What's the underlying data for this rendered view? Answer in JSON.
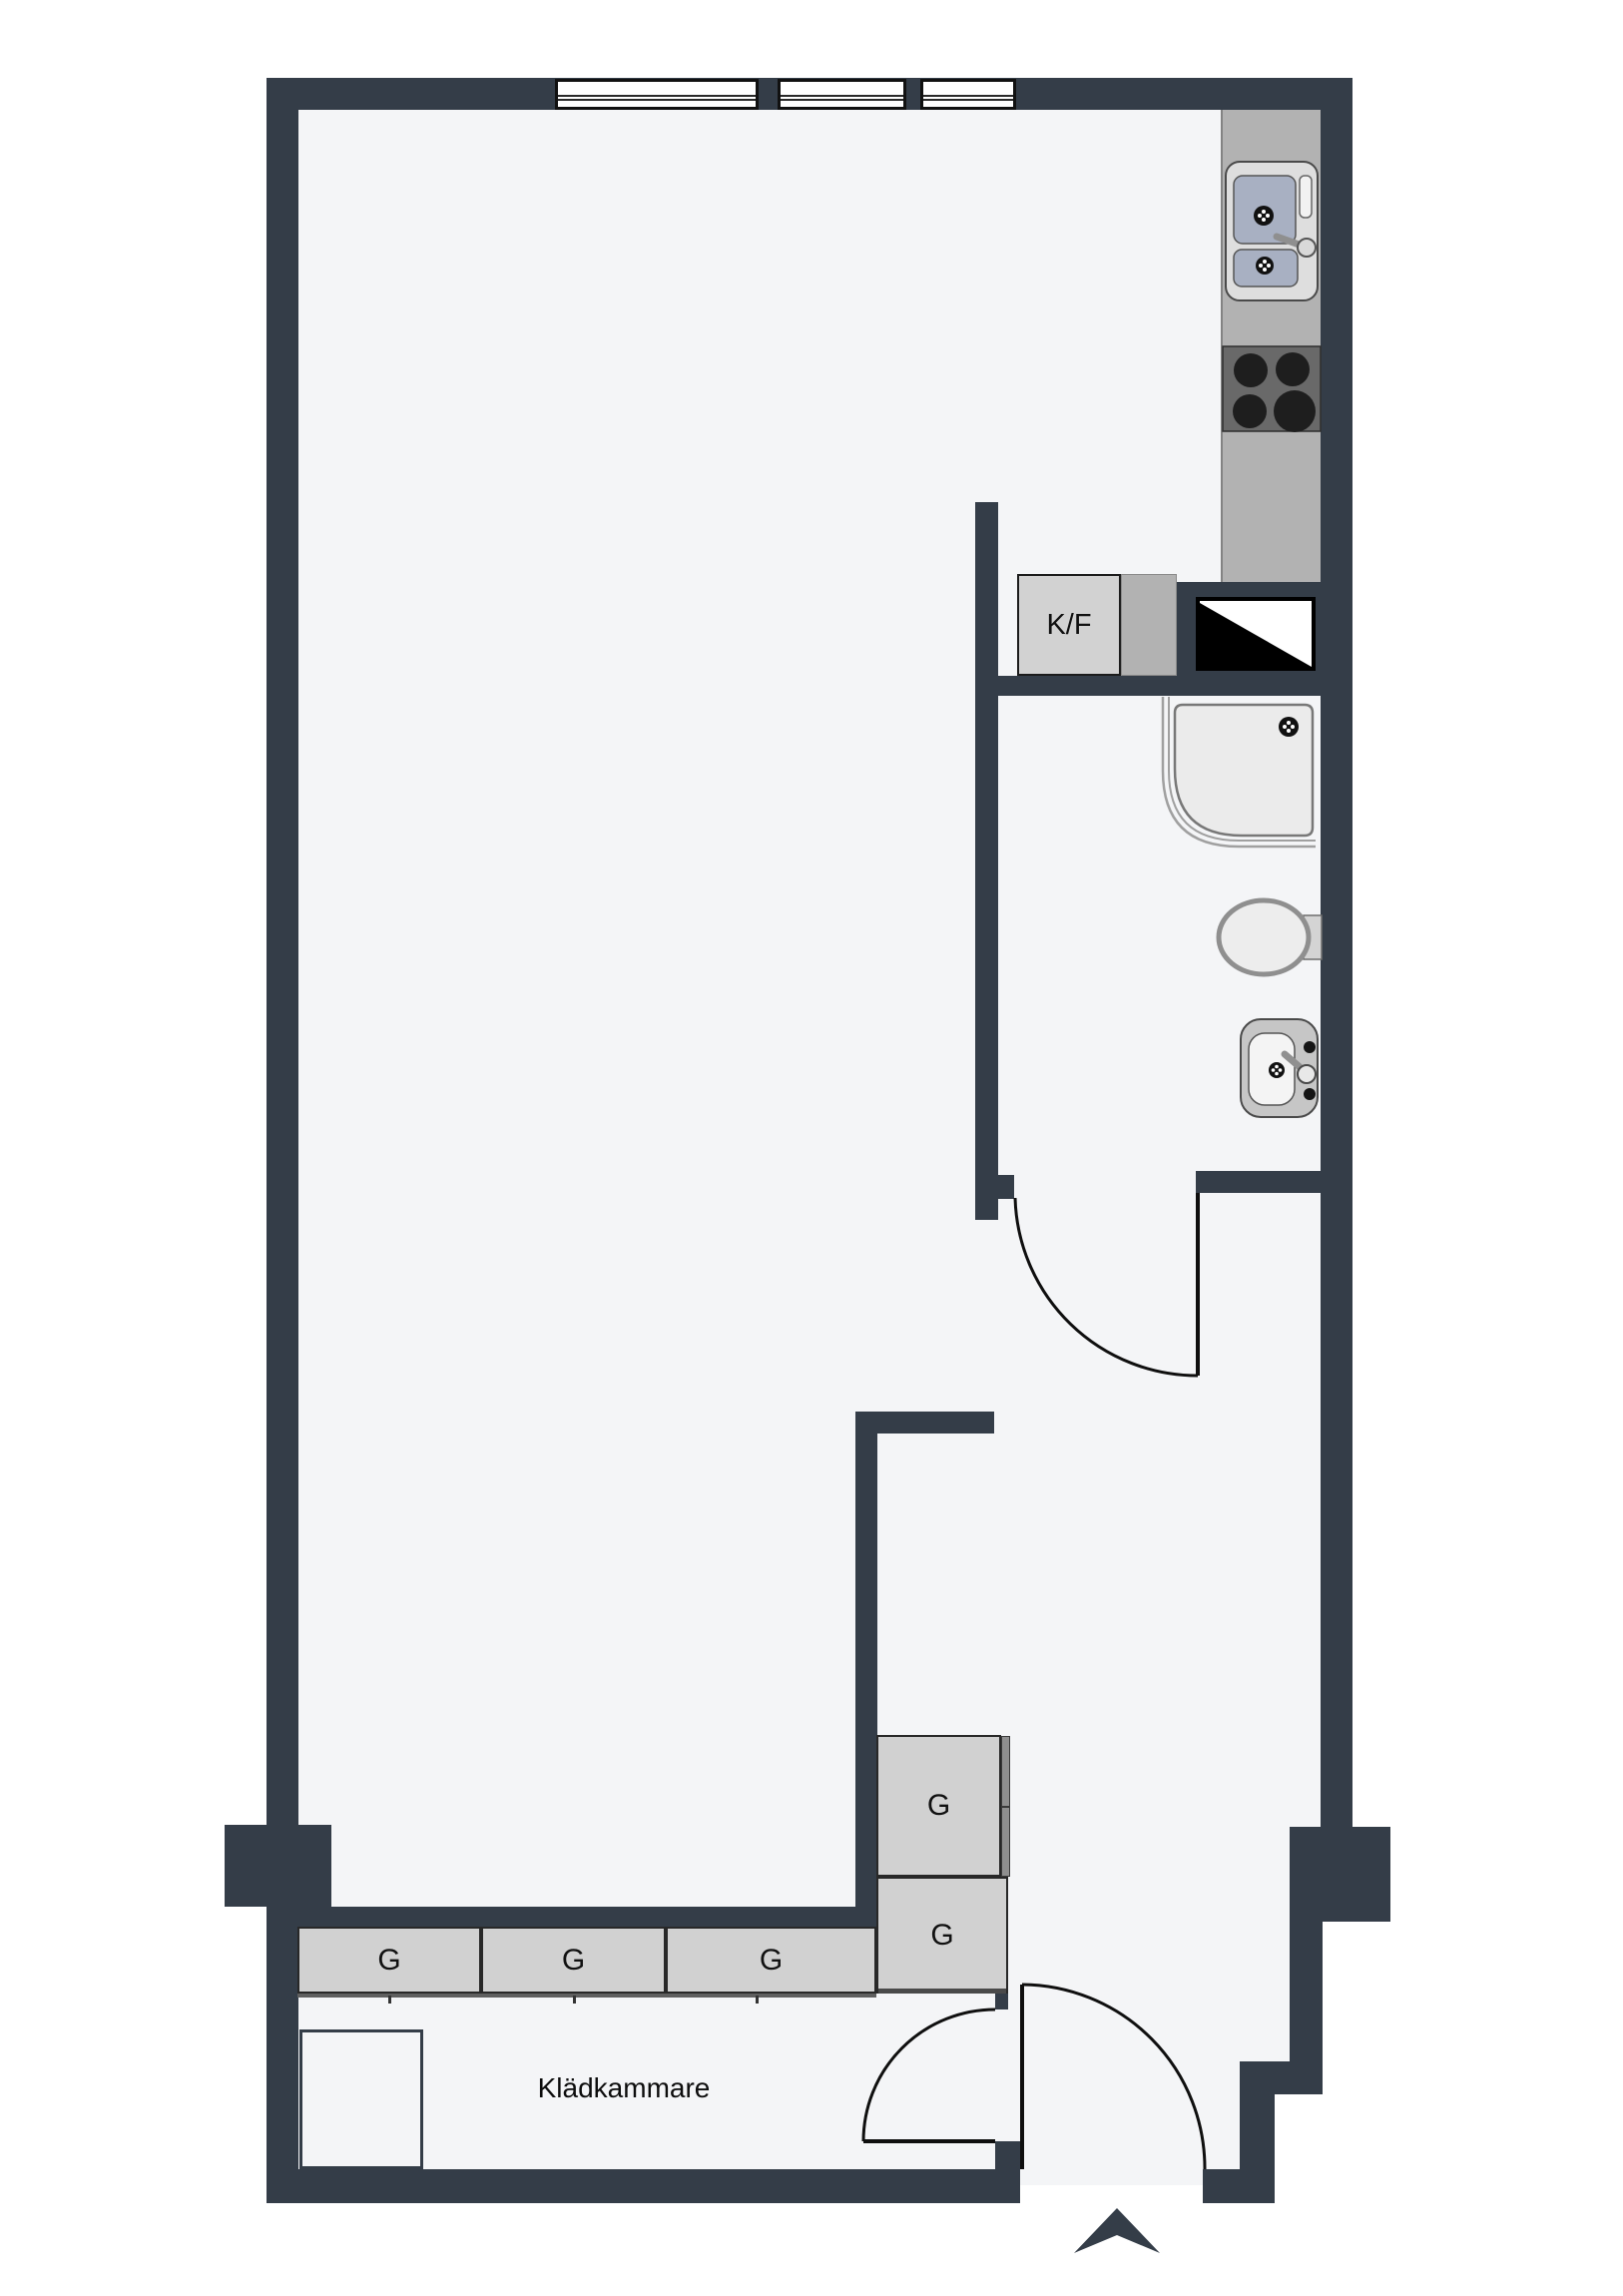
{
  "plan": {
    "type": "apartment-floor-plan",
    "labels": {
      "fridge_freezer": "K/F",
      "wardrobe": "G",
      "closet_room": "Klädkammare"
    },
    "wardrobe_count": 5,
    "window_count": 3,
    "colors": {
      "wall": "#343D48",
      "floor": "#F4F5F7",
      "counter": "#B2B2B2",
      "cabinet": "#D1D1D1",
      "appliance": "#D2D2D2",
      "basin": "#A8B0C2",
      "stove": "#696969",
      "burner": "#1E1E1E",
      "fixture": "#EBEBEB",
      "door_line": "#0F0F0F"
    },
    "icons": [
      "window-icon",
      "kitchen-sink-icon",
      "stove-icon",
      "fridge-symbol-icon",
      "shower-icon",
      "toilet-icon",
      "washbasin-icon",
      "door-swing-icon",
      "entrance-arrow-icon"
    ]
  }
}
